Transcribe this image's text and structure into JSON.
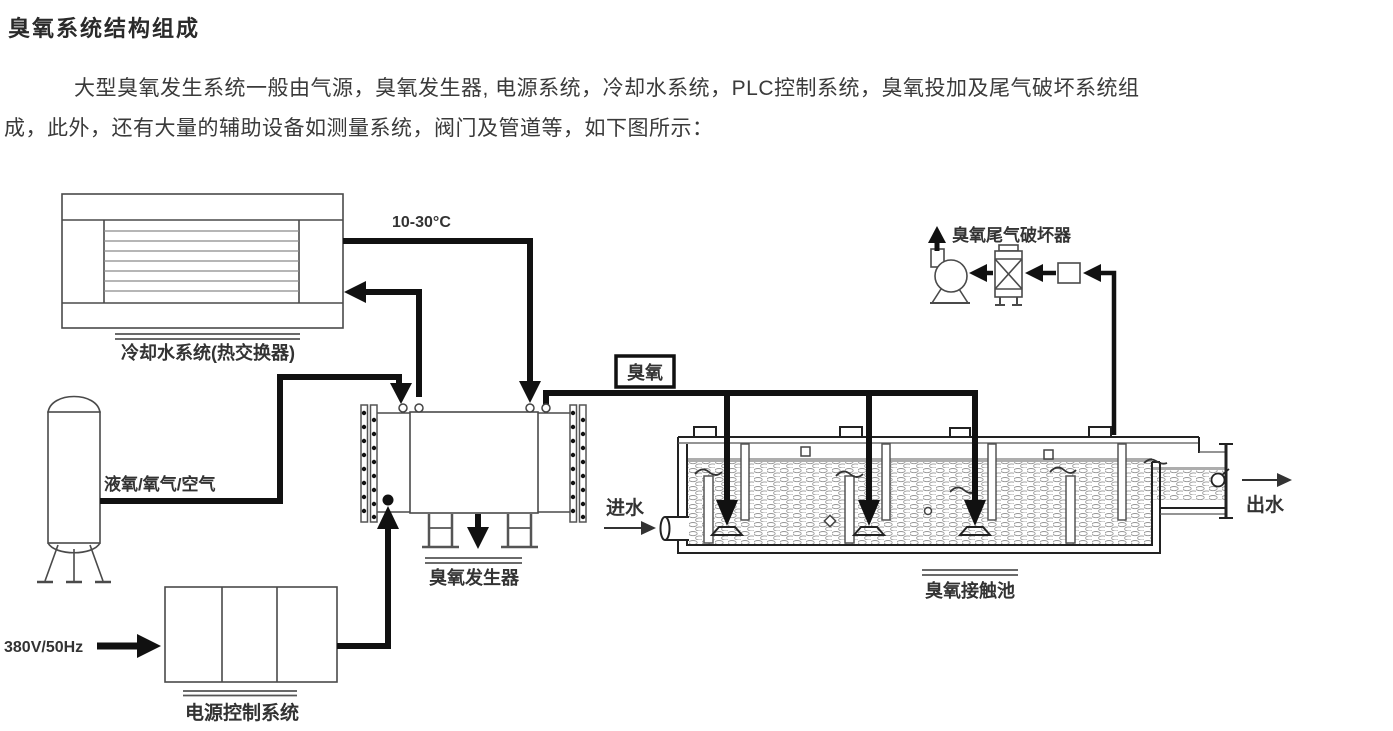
{
  "page": {
    "title": "臭氧系统结构组成",
    "paragraph_line1": "大型臭氧发生系统一般由气源，臭氧发生器, 电源系统，冷却水系统，PLC控制系统，臭氧投加及尾气破坏系统组",
    "paragraph_line2": "成，此外，还有大量的辅助设备如测量系统，阀门及管道等，如下图所示："
  },
  "diagram": {
    "labels": {
      "cooling_system": "冷却水系统(热交换器)",
      "water_temp": "10-30°C",
      "gas_source": "液氧/氧气/空气",
      "ozone_generator": "臭氧发生器",
      "power_input": "380V/50Hz",
      "power_control": "电源控制系统",
      "ozone": "臭氧",
      "water_in": "进水",
      "water_out": "出水",
      "contact_pool": "臭氧接触池",
      "offgas_destructor": "臭氧尾气破坏器"
    },
    "colors": {
      "pipe": "#111111",
      "equipment_line": "#4a4a4a",
      "label_text": "#333333",
      "background": "#ffffff"
    }
  }
}
